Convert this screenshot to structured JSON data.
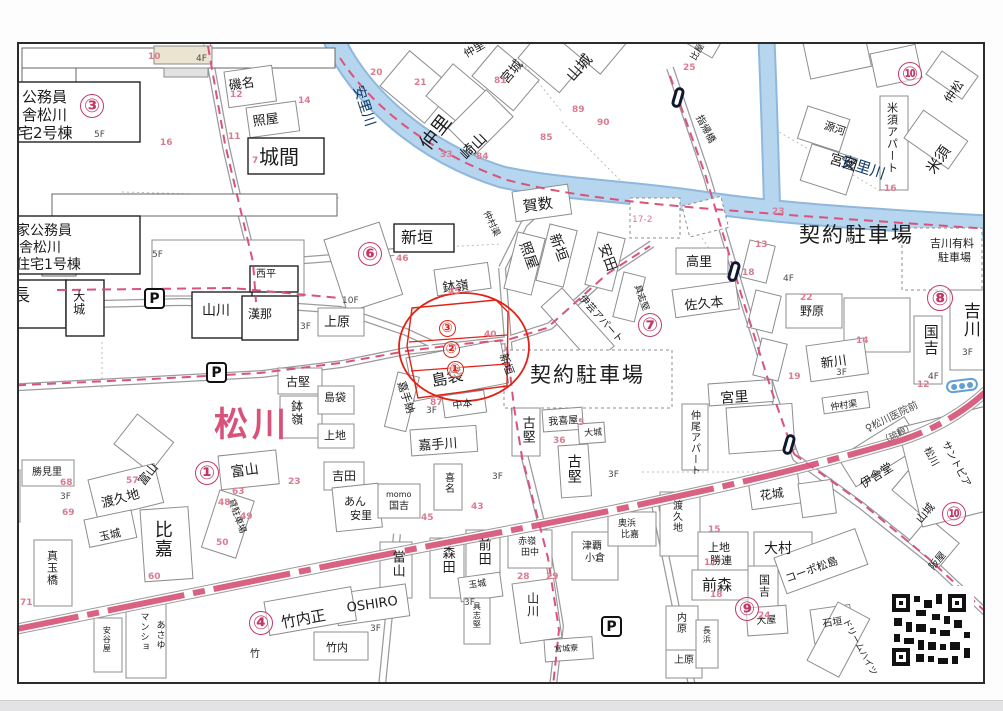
{
  "map": {
    "colors": {
      "accent_pink": "#c13a67",
      "annotation_red": "#e02318",
      "river": "#b6d5ee",
      "road_pink": "#d96283",
      "town_pink": "#d8527a",
      "lot_number_pink": "#db7b90"
    },
    "town_name": "松川",
    "labels": [
      {
        "t": "公務員",
        "x": 20,
        "y": 88,
        "s": 15
      },
      {
        "t": "舎松川",
        "x": 20,
        "y": 106,
        "s": 15
      },
      {
        "t": "宅2号棟",
        "x": 16,
        "y": 124,
        "s": 15
      },
      {
        "t": "家公務員",
        "x": 14,
        "y": 222,
        "s": 14
      },
      {
        "t": "舎松川",
        "x": 17,
        "y": 239,
        "s": 14
      },
      {
        "t": "住宅1号棟",
        "x": 14,
        "y": 256,
        "s": 14
      },
      {
        "t": "磯名",
        "x": 226,
        "y": 78,
        "s": 13,
        "r": -8
      },
      {
        "t": "照屋",
        "x": 250,
        "y": 114,
        "s": 13,
        "r": -8
      },
      {
        "t": "城間",
        "x": 257,
        "y": 145,
        "s": 20
      },
      {
        "t": "仲里",
        "x": 460,
        "y": 48,
        "s": 11,
        "r": -30
      },
      {
        "t": "仲里",
        "x": 415,
        "y": 140,
        "s": 19,
        "r": -52
      },
      {
        "t": "崎山",
        "x": 456,
        "y": 150,
        "s": 15,
        "r": -45
      },
      {
        "t": "宮城",
        "x": 497,
        "y": 76,
        "s": 13,
        "r": -50
      },
      {
        "t": "山城",
        "x": 562,
        "y": 72,
        "s": 15,
        "r": -48
      },
      {
        "t": "比屋根",
        "x": 688,
        "y": 56,
        "s": 9,
        "r": -60
      },
      {
        "t": "指帰橋",
        "x": 700,
        "y": 112,
        "s": 10,
        "r": 62
      },
      {
        "t": "安里川",
        "x": 362,
        "y": 82,
        "s": 14,
        "r": 72,
        "c": "#123a66"
      },
      {
        "t": "川",
        "x": 770,
        "y": 12,
        "s": 14,
        "r": 60,
        "c": "#123a66"
      },
      {
        "t": "安里川",
        "x": 842,
        "y": 152,
        "s": 15,
        "r": 18,
        "c": "#123a66"
      },
      {
        "t": "源河",
        "x": 824,
        "y": 118,
        "s": 11,
        "r": 18
      },
      {
        "t": "宮國",
        "x": 830,
        "y": 150,
        "s": 14,
        "r": 18
      },
      {
        "t": "米須アパート",
        "x": 884,
        "y": 100,
        "s": 11,
        "v": true
      },
      {
        "t": "仲松",
        "x": 940,
        "y": 96,
        "s": 12,
        "r": -55
      },
      {
        "t": "米須",
        "x": 922,
        "y": 166,
        "s": 15,
        "r": -55
      },
      {
        "t": "契約駐車場",
        "x": 797,
        "y": 222,
        "s": 21,
        "ls": 2
      },
      {
        "t": "吉川有料",
        "x": 928,
        "y": 236,
        "s": 11
      },
      {
        "t": "駐車場",
        "x": 936,
        "y": 250,
        "s": 11
      },
      {
        "t": "吉川",
        "x": 958,
        "y": 300,
        "s": 17,
        "v": true
      },
      {
        "t": "国吉",
        "x": 920,
        "y": 322,
        "s": 15,
        "v": true
      },
      {
        "t": "新垣",
        "x": 399,
        "y": 228,
        "s": 16
      },
      {
        "t": "鉢嶺",
        "x": 440,
        "y": 280,
        "s": 13,
        "r": -6
      },
      {
        "t": "仲村渠",
        "x": 487,
        "y": 208,
        "s": 9,
        "r": 65
      },
      {
        "t": "賀数",
        "x": 520,
        "y": 198,
        "s": 15,
        "r": -8
      },
      {
        "t": "照屋",
        "x": 528,
        "y": 238,
        "s": 14,
        "r": 70
      },
      {
        "t": "新垣",
        "x": 558,
        "y": 230,
        "s": 14,
        "r": 70
      },
      {
        "t": "安田",
        "x": 607,
        "y": 240,
        "s": 14,
        "r": 70
      },
      {
        "t": "伊芸アパート",
        "x": 582,
        "y": 292,
        "s": 10,
        "r": 48
      },
      {
        "t": "具志堅",
        "x": 638,
        "y": 282,
        "s": 9,
        "r": 70
      },
      {
        "t": "高里",
        "x": 684,
        "y": 254,
        "s": 13
      },
      {
        "t": "佐久本",
        "x": 682,
        "y": 298,
        "s": 13,
        "r": -6
      },
      {
        "t": "野原",
        "x": 798,
        "y": 303,
        "s": 12
      },
      {
        "t": "新川",
        "x": 818,
        "y": 356,
        "s": 13,
        "r": -8
      },
      {
        "t": "仲村渠",
        "x": 828,
        "y": 402,
        "s": 9,
        "r": -8
      },
      {
        "t": "宮里",
        "x": 718,
        "y": 390,
        "s": 14,
        "r": -4
      },
      {
        "t": "仲尾アパート",
        "x": 686,
        "y": 408,
        "s": 10,
        "v": true
      },
      {
        "t": "契約駐車場",
        "x": 528,
        "y": 362,
        "s": 21,
        "ls": 2
      },
      {
        "t": "新垣",
        "x": 506,
        "y": 350,
        "s": 11,
        "r": 70
      },
      {
        "t": "島袋",
        "x": 428,
        "y": 372,
        "s": 16,
        "r": -12
      },
      {
        "t": "嘉手納",
        "x": 404,
        "y": 378,
        "s": 11,
        "r": 72
      },
      {
        "t": "中本",
        "x": 450,
        "y": 400,
        "s": 10,
        "r": -8
      },
      {
        "t": "嘉手川",
        "x": 416,
        "y": 438,
        "s": 13,
        "r": -4
      },
      {
        "t": "古堅",
        "x": 518,
        "y": 414,
        "s": 13,
        "v": true
      },
      {
        "t": "我喜屋",
        "x": 546,
        "y": 416,
        "s": 10,
        "r": -4
      },
      {
        "t": "大城",
        "x": 582,
        "y": 428,
        "s": 9,
        "r": -4
      },
      {
        "t": "古堅",
        "x": 564,
        "y": 452,
        "s": 14,
        "v": true
      },
      {
        "t": "上原",
        "x": 322,
        "y": 314,
        "s": 13
      },
      {
        "t": "山川",
        "x": 200,
        "y": 302,
        "s": 14
      },
      {
        "t": "漢那",
        "x": 246,
        "y": 306,
        "s": 12
      },
      {
        "t": "西平",
        "x": 254,
        "y": 268,
        "s": 10
      },
      {
        "t": "大城",
        "x": 70,
        "y": 288,
        "s": 12,
        "v": true
      },
      {
        "t": "頴長",
        "x": -6,
        "y": 286,
        "s": 17
      },
      {
        "t": "古堅",
        "x": 284,
        "y": 374,
        "s": 12
      },
      {
        "t": "鉢嶺",
        "x": 288,
        "y": 398,
        "s": 12,
        "v": true
      },
      {
        "t": "島袋",
        "x": 322,
        "y": 390,
        "s": 11
      },
      {
        "t": "上地",
        "x": 322,
        "y": 428,
        "s": 11
      },
      {
        "t": "吉田",
        "x": 330,
        "y": 468,
        "s": 12
      },
      {
        "t": "あん",
        "x": 342,
        "y": 494,
        "s": 11
      },
      {
        "t": "安里",
        "x": 348,
        "y": 508,
        "s": 11
      },
      {
        "t": "momo",
        "x": 384,
        "y": 489,
        "s": 8
      },
      {
        "t": "国吉",
        "x": 387,
        "y": 500,
        "s": 10
      },
      {
        "t": "喜名",
        "x": 440,
        "y": 470,
        "s": 10,
        "v": true
      },
      {
        "t": "當山",
        "x": 388,
        "y": 548,
        "s": 13,
        "v": true
      },
      {
        "t": "森田",
        "x": 438,
        "y": 544,
        "s": 13,
        "v": true
      },
      {
        "t": "前田",
        "x": 474,
        "y": 536,
        "s": 13,
        "v": true
      },
      {
        "t": "玉城",
        "x": 466,
        "y": 580,
        "s": 9,
        "r": -8
      },
      {
        "t": "赤嶺",
        "x": 516,
        "y": 536,
        "s": 9
      },
      {
        "t": "田中",
        "x": 519,
        "y": 547,
        "s": 9
      },
      {
        "t": "山川",
        "x": 524,
        "y": 590,
        "s": 12,
        "v": true
      },
      {
        "t": "津覇",
        "x": 580,
        "y": 540,
        "s": 10
      },
      {
        "t": "小倉",
        "x": 583,
        "y": 552,
        "s": 10
      },
      {
        "t": "奥浜",
        "x": 616,
        "y": 518,
        "s": 9
      },
      {
        "t": "比嘉",
        "x": 619,
        "y": 529,
        "s": 9
      },
      {
        "t": "宮城寮",
        "x": 552,
        "y": 644,
        "s": 8,
        "r": -4
      },
      {
        "t": "具志堅",
        "x": 470,
        "y": 600,
        "s": 8,
        "v": true
      },
      {
        "t": "内原",
        "x": 672,
        "y": 610,
        "s": 10,
        "v": true
      },
      {
        "t": "上原",
        "x": 672,
        "y": 654,
        "s": 10
      },
      {
        "t": "長浜",
        "x": 700,
        "y": 624,
        "s": 8,
        "v": true
      },
      {
        "t": "渡久地",
        "x": 668,
        "y": 498,
        "s": 10,
        "v": true
      },
      {
        "t": "上地",
        "x": 706,
        "y": 540,
        "s": 11
      },
      {
        "t": "勝連",
        "x": 708,
        "y": 553,
        "s": 11
      },
      {
        "t": "前森",
        "x": 700,
        "y": 576,
        "s": 15
      },
      {
        "t": "国吉",
        "x": 756,
        "y": 572,
        "s": 11,
        "v": true
      },
      {
        "t": "花城",
        "x": 757,
        "y": 488,
        "s": 12,
        "r": -8
      },
      {
        "t": "大村",
        "x": 762,
        "y": 540,
        "s": 14
      },
      {
        "t": "大屋",
        "x": 754,
        "y": 615,
        "s": 10,
        "r": -4
      },
      {
        "t": "コーポ松島",
        "x": 782,
        "y": 572,
        "s": 11,
        "r": -20
      },
      {
        "t": "石垣",
        "x": 820,
        "y": 618,
        "s": 10,
        "r": -8
      },
      {
        "t": "ドリームハイツ",
        "x": 846,
        "y": 616,
        "s": 9,
        "r": 62
      },
      {
        "t": "伊舎堂",
        "x": 856,
        "y": 478,
        "s": 12,
        "r": -32
      },
      {
        "t": "山城",
        "x": 912,
        "y": 516,
        "s": 11,
        "r": -50
      },
      {
        "t": "阪屋",
        "x": 926,
        "y": 564,
        "s": 10,
        "r": -50
      },
      {
        "t": "松川",
        "x": 928,
        "y": 444,
        "s": 10,
        "r": 62
      },
      {
        "t": "サントピア",
        "x": 946,
        "y": 438,
        "s": 10,
        "r": 62
      },
      {
        "t": "♀松川医院前",
        "x": 862,
        "y": 424,
        "s": 10,
        "r": -26,
        "c": "#4a4a4a"
      },
      {
        "t": "（琉観）",
        "x": 878,
        "y": 437,
        "s": 9,
        "r": -26,
        "c": "#4a4a4a"
      },
      {
        "t": "渡久地",
        "x": 98,
        "y": 496,
        "s": 13,
        "r": -15
      },
      {
        "t": "玉城",
        "x": 96,
        "y": 530,
        "s": 11,
        "r": -12
      },
      {
        "t": "比嘉",
        "x": 150,
        "y": 518,
        "s": 18,
        "v": true
      },
      {
        "t": "真玉橋",
        "x": 44,
        "y": 548,
        "s": 11,
        "v": true
      },
      {
        "t": "濱",
        "x": 2,
        "y": 478,
        "s": 12,
        "v": true
      },
      {
        "t": "勝見里",
        "x": 30,
        "y": 466,
        "s": 10
      },
      {
        "t": "貸駐車場",
        "x": 232,
        "y": 496,
        "s": 9,
        "r": 70
      },
      {
        "t": "富山",
        "x": 134,
        "y": 478,
        "s": 12,
        "r": -52
      },
      {
        "t": "富山",
        "x": 228,
        "y": 464,
        "s": 14,
        "r": -8
      },
      {
        "t": "竹内正",
        "x": 278,
        "y": 614,
        "s": 15,
        "r": -10
      },
      {
        "t": "竹内",
        "x": 324,
        "y": 640,
        "s": 11
      },
      {
        "t": "竹",
        "x": 248,
        "y": 648,
        "s": 10
      },
      {
        "t": "OSHIRO",
        "x": 344,
        "y": 600,
        "s": 13,
        "r": -8
      },
      {
        "t": "マンショ",
        "x": 136,
        "y": 610,
        "s": 9,
        "v": true
      },
      {
        "t": "あさゆ",
        "x": 152,
        "y": 618,
        "s": 9,
        "v": true
      },
      {
        "t": "安谷屋",
        "x": 100,
        "y": 624,
        "s": 8,
        "v": true
      },
      {
        "t": "松川",
        "x": 212,
        "y": 406,
        "s": 34,
        "c": "#d8527a",
        "b": true,
        "ls": 4
      },
      {
        "t": "17-2",
        "x": 630,
        "y": 214,
        "s": 9,
        "c": "#db7b90"
      }
    ],
    "circled": [
      {
        "n": "③",
        "x": 90,
        "y": 104,
        "d": 24,
        "c": "#c13a67"
      },
      {
        "n": "⑥",
        "x": 368,
        "y": 252,
        "d": 24,
        "c": "#c13a67"
      },
      {
        "n": "①",
        "x": 205,
        "y": 471,
        "d": 24,
        "c": "#c13a67"
      },
      {
        "n": "④",
        "x": 259,
        "y": 621,
        "d": 24,
        "c": "#c13a67"
      },
      {
        "n": "⑦",
        "x": 648,
        "y": 323,
        "d": 24,
        "c": "#c13a67"
      },
      {
        "n": "⑧",
        "x": 938,
        "y": 296,
        "d": 26,
        "c": "#c13a67"
      },
      {
        "n": "⑨",
        "x": 745,
        "y": 607,
        "d": 24,
        "c": "#c13a67"
      },
      {
        "n": "⑩",
        "x": 908,
        "y": 72,
        "d": 24,
        "c": "#c13a67"
      },
      {
        "n": "⑩",
        "x": 952,
        "y": 512,
        "d": 24,
        "c": "#c13a67"
      },
      {
        "n": "③",
        "x": 445,
        "y": 326,
        "d": 17,
        "c": "#e02318"
      },
      {
        "n": "②",
        "x": 449,
        "y": 347,
        "d": 17,
        "c": "#e02318"
      },
      {
        "n": "①",
        "x": 453,
        "y": 367,
        "d": 17,
        "c": "#e02318"
      }
    ],
    "red_numbers": [
      {
        "t": "10",
        "x": 146,
        "y": 50
      },
      {
        "t": "12",
        "x": 228,
        "y": 88
      },
      {
        "t": "11",
        "x": 226,
        "y": 130
      },
      {
        "t": "14",
        "x": 296,
        "y": 94
      },
      {
        "t": "16",
        "x": 158,
        "y": 136
      },
      {
        "t": "7",
        "x": 250,
        "y": 154
      },
      {
        "t": "20",
        "x": 368,
        "y": 66
      },
      {
        "t": "21",
        "x": 412,
        "y": 76
      },
      {
        "t": "81",
        "x": 492,
        "y": 74
      },
      {
        "t": "33",
        "x": 438,
        "y": 148
      },
      {
        "t": "84",
        "x": 474,
        "y": 150
      },
      {
        "t": "85",
        "x": 538,
        "y": 131
      },
      {
        "t": "89",
        "x": 570,
        "y": 103
      },
      {
        "t": "90",
        "x": 595,
        "y": 116
      },
      {
        "t": "25",
        "x": 681,
        "y": 61
      },
      {
        "t": "23",
        "x": 770,
        "y": 205
      },
      {
        "t": "13",
        "x": 753,
        "y": 238
      },
      {
        "t": "16",
        "x": 882,
        "y": 182
      },
      {
        "t": "46",
        "x": 394,
        "y": 252
      },
      {
        "t": "45",
        "x": 446,
        "y": 285
      },
      {
        "t": "40",
        "x": 482,
        "y": 328
      },
      {
        "t": "87",
        "x": 428,
        "y": 396
      },
      {
        "t": "36",
        "x": 551,
        "y": 434
      },
      {
        "t": "5",
        "x": 576,
        "y": 416
      },
      {
        "t": "22",
        "x": 798,
        "y": 291
      },
      {
        "t": "19",
        "x": 786,
        "y": 370
      },
      {
        "t": "18",
        "x": 740,
        "y": 266
      },
      {
        "t": "14",
        "x": 854,
        "y": 334
      },
      {
        "t": "12",
        "x": 915,
        "y": 378
      },
      {
        "t": "57",
        "x": 124,
        "y": 474
      },
      {
        "t": "63",
        "x": 230,
        "y": 485
      },
      {
        "t": "23",
        "x": 286,
        "y": 475
      },
      {
        "t": "68",
        "x": 58,
        "y": 476
      },
      {
        "t": "69",
        "x": 60,
        "y": 506
      },
      {
        "t": "71",
        "x": 18,
        "y": 596
      },
      {
        "t": "60",
        "x": 146,
        "y": 570
      },
      {
        "t": "50",
        "x": 214,
        "y": 536
      },
      {
        "t": "48",
        "x": 216,
        "y": 496
      },
      {
        "t": "49",
        "x": 238,
        "y": 510
      },
      {
        "t": "29",
        "x": 544,
        "y": 570
      },
      {
        "t": "28",
        "x": 515,
        "y": 570
      },
      {
        "t": "15",
        "x": 706,
        "y": 523
      },
      {
        "t": "17",
        "x": 702,
        "y": 556
      },
      {
        "t": "18",
        "x": 708,
        "y": 588
      },
      {
        "t": "24",
        "x": 756,
        "y": 609
      },
      {
        "t": "43",
        "x": 469,
        "y": 500
      },
      {
        "t": "45",
        "x": 419,
        "y": 511
      }
    ],
    "floors": [
      {
        "t": "4F",
        "x": 194,
        "y": 52
      },
      {
        "t": "5F",
        "x": 92,
        "y": 128
      },
      {
        "t": "5F",
        "x": 150,
        "y": 248
      },
      {
        "t": "10F",
        "x": 340,
        "y": 294
      },
      {
        "t": "3F",
        "x": 298,
        "y": 320
      },
      {
        "t": "3F",
        "x": 424,
        "y": 404
      },
      {
        "t": "4F",
        "x": 781,
        "y": 272
      },
      {
        "t": "3F",
        "x": 834,
        "y": 366
      },
      {
        "t": "4F",
        "x": 926,
        "y": 370
      },
      {
        "t": "3F",
        "x": 960,
        "y": 346
      },
      {
        "t": "3F",
        "x": 490,
        "y": 470
      },
      {
        "t": "3F",
        "x": 606,
        "y": 468
      },
      {
        "t": "3F",
        "x": 368,
        "y": 622
      },
      {
        "t": "3F",
        "x": 462,
        "y": 596
      },
      {
        "t": "3F",
        "x": 58,
        "y": 490
      }
    ],
    "icons": {
      "parking_label": "P",
      "parking": [
        {
          "x": 142,
          "y": 286
        },
        {
          "x": 204,
          "y": 360
        },
        {
          "x": 599,
          "y": 614
        }
      ],
      "bus_stops": [
        {
          "x": 671,
          "y": 85
        },
        {
          "x": 727,
          "y": 259
        },
        {
          "x": 782,
          "y": 432
        }
      ],
      "signal": {
        "x": 944,
        "y": 377
      }
    }
  }
}
